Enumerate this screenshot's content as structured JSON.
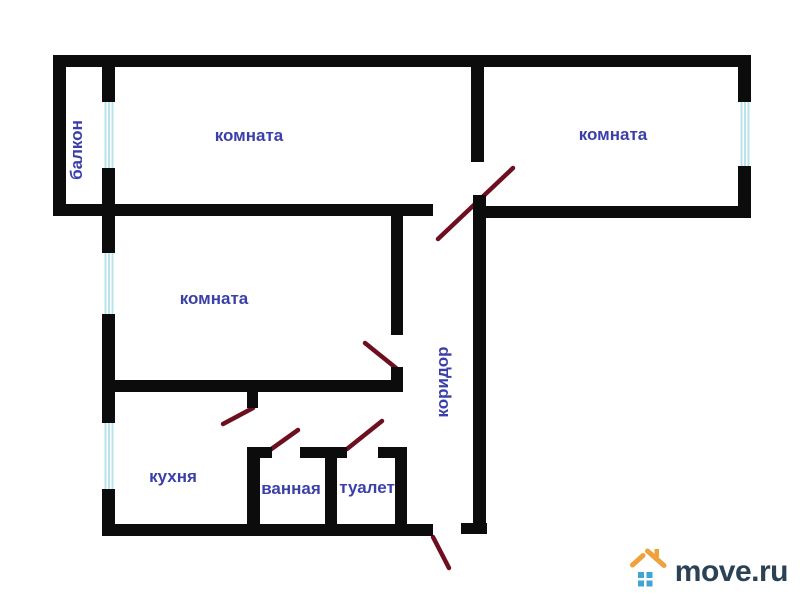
{
  "branding": {
    "logo_text": "move.ru",
    "roof_color": "#efa23b",
    "squares_color": "#42a4d2",
    "text_color": "#2a4156"
  },
  "plan": {
    "wall_color": "#0c0c0c",
    "door_color": "#6e0f1f",
    "window_stripe_color": "#b9e3ea",
    "label_color": "#3b3fa8",
    "labels": [
      {
        "name": "balcony",
        "text": "балкон",
        "x": 77,
        "y": 150,
        "vertical": true
      },
      {
        "name": "room-1",
        "text": "комната",
        "x": 249,
        "y": 136,
        "vertical": false
      },
      {
        "name": "room-2",
        "text": "комната",
        "x": 613,
        "y": 135,
        "vertical": false
      },
      {
        "name": "room-3",
        "text": "комната",
        "x": 214,
        "y": 299,
        "vertical": false
      },
      {
        "name": "corridor",
        "text": "коридор",
        "x": 443,
        "y": 382,
        "vertical": true
      },
      {
        "name": "kitchen",
        "text": "кухня",
        "x": 173,
        "y": 477,
        "vertical": false
      },
      {
        "name": "bathroom",
        "text": "ванная",
        "x": 291,
        "y": 489,
        "vertical": false
      },
      {
        "name": "toilet",
        "text": "туалет",
        "x": 367,
        "y": 488,
        "vertical": false
      }
    ],
    "walls": [
      {
        "name": "outer-top-wall",
        "x": 53,
        "y": 55,
        "w": 698,
        "h": 12
      },
      {
        "name": "outer-left-wall",
        "x": 53,
        "y": 55,
        "w": 13,
        "h": 161
      },
      {
        "name": "balcony-inner-wall-upper",
        "x": 102,
        "y": 55,
        "w": 13,
        "h": 47
      },
      {
        "name": "balcony-inner-wall-lower",
        "x": 102,
        "y": 168,
        "w": 13,
        "h": 48
      },
      {
        "name": "top-rooms-divider-wall",
        "x": 471,
        "y": 55,
        "w": 13,
        "h": 107
      },
      {
        "name": "outer-right-wall-upper",
        "x": 738,
        "y": 55,
        "w": 13,
        "h": 47
      },
      {
        "name": "outer-right-wall-lower",
        "x": 738,
        "y": 166,
        "w": 13,
        "h": 52
      },
      {
        "name": "hall-top-wall",
        "x": 53,
        "y": 204,
        "w": 380,
        "h": 12
      },
      {
        "name": "right-room-bottom-wall",
        "x": 473,
        "y": 206,
        "w": 278,
        "h": 12
      },
      {
        "name": "corridor-right-wall",
        "x": 473,
        "y": 195,
        "w": 13,
        "h": 339
      },
      {
        "name": "corridor-right-wall-foot",
        "x": 461,
        "y": 523,
        "w": 26,
        "h": 11
      },
      {
        "name": "mid-room-left-wall-upper",
        "x": 102,
        "y": 216,
        "w": 13,
        "h": 37
      },
      {
        "name": "mid-room-left-wall-mid",
        "x": 102,
        "y": 314,
        "w": 13,
        "h": 109
      },
      {
        "name": "left-wall-bottom",
        "x": 102,
        "y": 489,
        "w": 13,
        "h": 47
      },
      {
        "name": "mid-room-right-wall-upper",
        "x": 391,
        "y": 216,
        "w": 12,
        "h": 119
      },
      {
        "name": "mid-room-right-wall-lower",
        "x": 391,
        "y": 367,
        "w": 12,
        "h": 25
      },
      {
        "name": "mid-room-bottom-wall",
        "x": 108,
        "y": 380,
        "w": 295,
        "h": 12
      },
      {
        "name": "kitchen-door-stub-wall",
        "x": 247,
        "y": 392,
        "w": 11,
        "h": 16
      },
      {
        "name": "bathroom-top-wall-left",
        "x": 247,
        "y": 447,
        "w": 25,
        "h": 11
      },
      {
        "name": "bathroom-top-wall-mid",
        "x": 300,
        "y": 447,
        "w": 47,
        "h": 11
      },
      {
        "name": "bathroom-toilet-divider",
        "x": 325,
        "y": 447,
        "w": 12,
        "h": 89
      },
      {
        "name": "toilet-top-wall-right",
        "x": 378,
        "y": 447,
        "w": 29,
        "h": 11
      },
      {
        "name": "toilet-right-wall",
        "x": 395,
        "y": 447,
        "w": 12,
        "h": 89
      },
      {
        "name": "bathroom-left-wall",
        "x": 247,
        "y": 447,
        "w": 13,
        "h": 89
      },
      {
        "name": "outer-bottom-wall",
        "x": 102,
        "y": 524,
        "w": 331,
        "h": 12
      }
    ],
    "windows": [
      {
        "name": "balcony-window",
        "x": 103,
        "y": 102,
        "w": 11,
        "h": 66
      },
      {
        "name": "mid-room-window",
        "x": 103,
        "y": 253,
        "w": 11,
        "h": 61
      },
      {
        "name": "kitchen-window",
        "x": 103,
        "y": 423,
        "w": 11,
        "h": 66
      },
      {
        "name": "right-room-window",
        "x": 739,
        "y": 102,
        "w": 11,
        "h": 64
      }
    ],
    "doors": [
      {
        "name": "right-room-door-swing",
        "x1": 438,
        "y1": 239,
        "x2": 513,
        "y2": 168
      },
      {
        "name": "mid-room-door-swing",
        "x1": 365,
        "y1": 343,
        "x2": 396,
        "y2": 368
      },
      {
        "name": "kitchen-door-swing",
        "x1": 223,
        "y1": 424,
        "x2": 253,
        "y2": 408
      },
      {
        "name": "bathroom-door-swing",
        "x1": 270,
        "y1": 450,
        "x2": 298,
        "y2": 430
      },
      {
        "name": "toilet-door-swing",
        "x1": 347,
        "y1": 449,
        "x2": 382,
        "y2": 421
      },
      {
        "name": "entrance-door-swing",
        "x1": 433,
        "y1": 537,
        "x2": 449,
        "y2": 568
      }
    ]
  }
}
